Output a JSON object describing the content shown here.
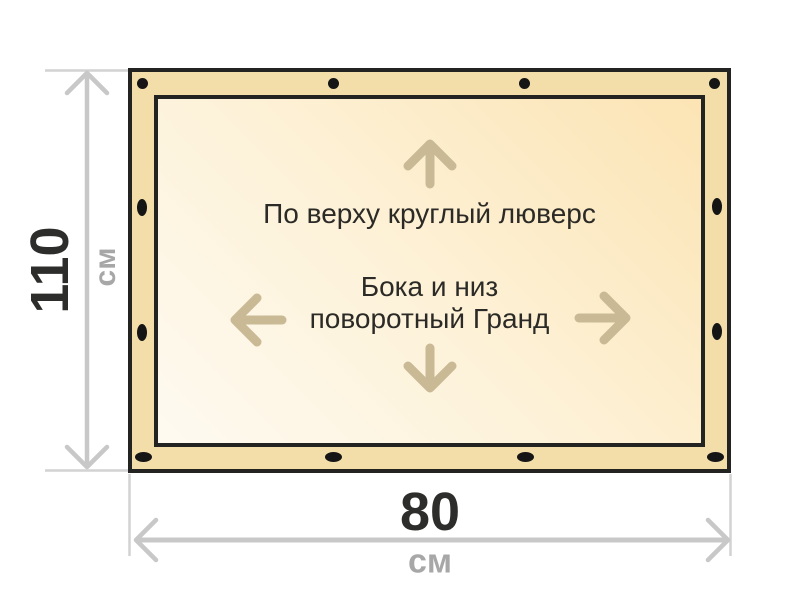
{
  "banner": {
    "top_note": "По верху круглый люверс",
    "side_note_line1": "Бока и низ",
    "side_note_line2": "поворотный Гранд",
    "grommets": {
      "top": {
        "count": 4,
        "shape": "round"
      },
      "left": {
        "count": 2,
        "shape": "oval-vertical"
      },
      "right": {
        "count": 2,
        "shape": "oval-vertical"
      },
      "bottom": {
        "count": 4,
        "shape": "oval-horizontal"
      }
    }
  },
  "dimensions": {
    "height": {
      "value": "110",
      "unit": "см"
    },
    "width": {
      "value": "80",
      "unit": "см"
    }
  },
  "icons": {
    "direction_arrows": [
      "arrow-up",
      "arrow-left",
      "arrow-right",
      "arrow-down"
    ]
  },
  "colors": {
    "background": "#ffffff",
    "banner_band": "#f3dda9",
    "banner_inner_light": "#fefaf1",
    "banner_inner_dark": "#fce4b4",
    "border": "#232321",
    "grommet": "#151515",
    "dimension_line": "#c8c8c8",
    "extension_line": "#d2d2d2",
    "dimension_value_text": "#2d2d2b",
    "dimension_unit_text": "#a7a7a7",
    "note_text": "#2b2a26",
    "direction_arrow": "#c9ba95"
  }
}
